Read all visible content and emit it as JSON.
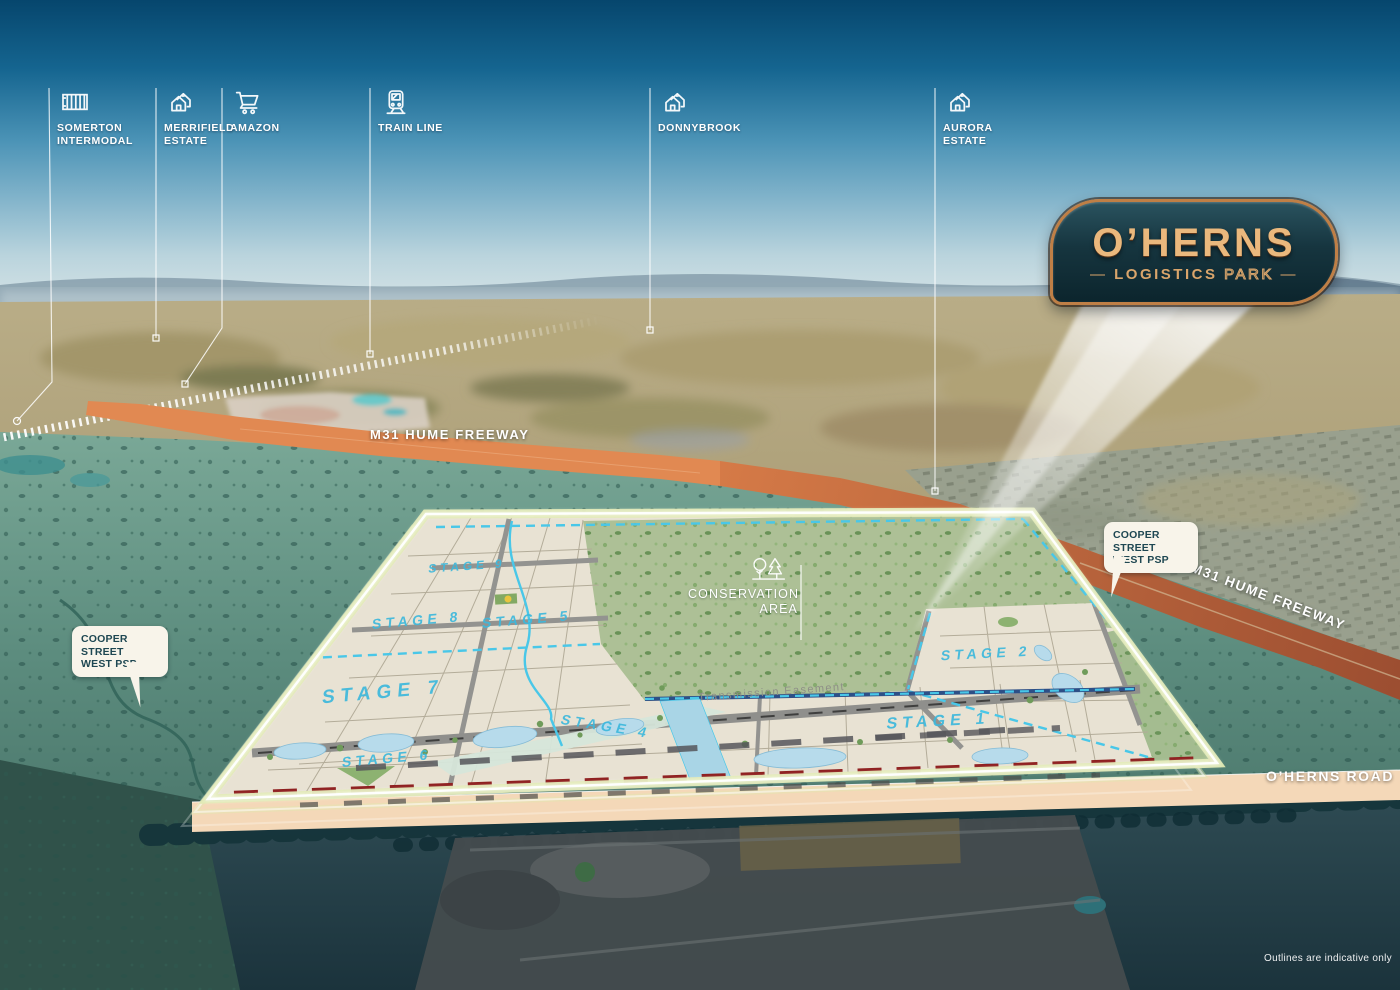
{
  "page": {
    "disclaimer": "Outlines are indicative only"
  },
  "logo": {
    "title": "O’HERNS",
    "dash": "—",
    "subtitle_bold": "LOGISTICS",
    "subtitle_outline": "PARK"
  },
  "markers": [
    {
      "name": "somerton-intermodal",
      "icon": "container",
      "label": "SOMERTON\nINTERMODAL",
      "line": [
        [
          49,
          88
        ],
        [
          52,
          382
        ],
        [
          17,
          421
        ]
      ],
      "end": "circle"
    },
    {
      "name": "merrifield-estate",
      "icon": "house",
      "label": "MERRIFIELD\nESTATE",
      "line": [
        [
          156,
          88
        ],
        [
          156,
          338
        ]
      ],
      "end": "square"
    },
    {
      "name": "amazon",
      "icon": "cart",
      "label": "AMAZON",
      "line": [
        [
          222,
          88
        ],
        [
          222,
          328
        ],
        [
          185,
          384
        ]
      ],
      "end": "square"
    },
    {
      "name": "train-line",
      "icon": "train",
      "label": "TRAIN LINE",
      "line": [
        [
          370,
          88
        ],
        [
          370,
          354
        ]
      ],
      "end": "square"
    },
    {
      "name": "donnybrook",
      "icon": "house",
      "label": "DONNYBROOK",
      "line": [
        [
          650,
          88
        ],
        [
          650,
          330
        ]
      ],
      "end": "square"
    },
    {
      "name": "aurora-estate",
      "icon": "house",
      "label": "AURORA\nESTATE",
      "line": [
        [
          935,
          88
        ],
        [
          935,
          491
        ]
      ],
      "end": "square"
    }
  ],
  "roads": {
    "freeway_left": "M31 HUME FREEWAY",
    "freeway_right": "M31 HUME FREEWAY",
    "oherns_road": "O’HERNS ROAD"
  },
  "callouts": {
    "cooper_left": "COOPER STREET\nWEST PSP",
    "cooper_right": "COOPER STREET\nWEST PSP"
  },
  "site": {
    "conservation_label": "CONSERVATION\nAREA",
    "easement_label": "Transmission Easement",
    "stages": [
      {
        "label": "STAGE 9",
        "x": 467,
        "y": 566,
        "size": 12,
        "rot": -4
      },
      {
        "label": "STAGE 8",
        "x": 417,
        "y": 620,
        "size": 14,
        "rot": -5
      },
      {
        "label": "STAGE 5",
        "x": 527,
        "y": 619,
        "size": 14,
        "rot": -5
      },
      {
        "label": "STAGE 7",
        "x": 383,
        "y": 693,
        "size": 19,
        "rot": -5
      },
      {
        "label": "STAGE 6",
        "x": 387,
        "y": 758,
        "size": 14,
        "rot": -5
      },
      {
        "label": "STAGE 4",
        "x": 606,
        "y": 726,
        "size": 14,
        "rot": 9
      },
      {
        "label": "STAGE 2",
        "x": 986,
        "y": 653,
        "size": 14,
        "rot": -3
      },
      {
        "label": "STAGE 1",
        "x": 938,
        "y": 722,
        "size": 16,
        "rot": -3
      }
    ]
  },
  "colors": {
    "freeway_orange": "#e08550",
    "freeway_rust": "#9c4e31",
    "stage_cyan": "#3db8dc",
    "badge_teal": "#16353f",
    "badge_copper": "#dca86e",
    "callout_text": "#1e4752",
    "oherns_road_fill": "#f4d8b8",
    "conservation_green": "#adc096",
    "parcel_cream": "#e8e2d3"
  }
}
